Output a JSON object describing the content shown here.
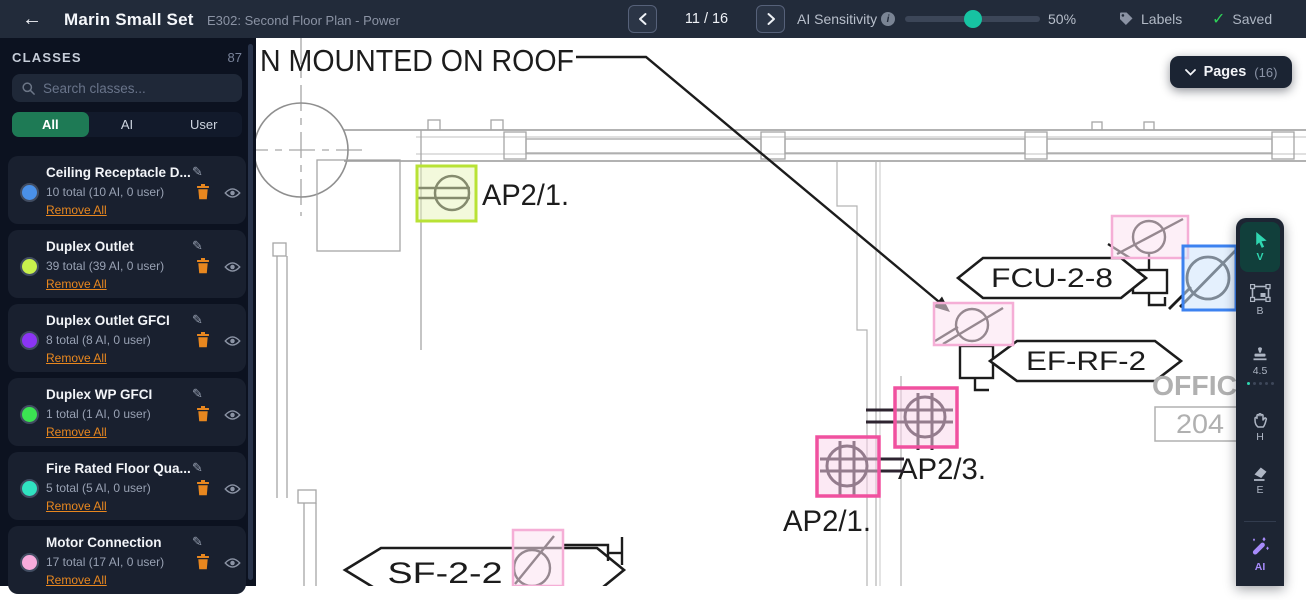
{
  "topbar": {
    "title": "Marin Small Set",
    "subtitle": "E302: Second Floor Plan - Power",
    "page_indicator": "11 / 16",
    "ai_sensitivity": {
      "label": "AI Sensitivity",
      "display": "50%"
    },
    "labels_button": "Labels",
    "saved_status": "Saved"
  },
  "sidebar": {
    "header": "CLASSES",
    "total_count": "87",
    "search": {
      "placeholder": "Search classes..."
    },
    "filter_tabs": {
      "options": [
        "All",
        "AI",
        "User"
      ],
      "active": "All"
    },
    "classes": [
      {
        "name": "Ceiling Receptacle D...",
        "color": "#4a90e8",
        "count_text": "10 total (10 AI, 0 user)",
        "remove_label": "Remove All"
      },
      {
        "name": "Duplex Outlet",
        "color": "#c8f04d",
        "count_text": "39 total (39 AI, 0 user)",
        "remove_label": "Remove All"
      },
      {
        "name": "Duplex Outlet GFCI",
        "color": "#8b35f4",
        "count_text": "8 total (8 AI, 0 user)",
        "remove_label": "Remove All"
      },
      {
        "name": "Duplex WP GFCI",
        "color": "#3be352",
        "count_text": "1 total (1 AI, 0 user)",
        "remove_label": "Remove All"
      },
      {
        "name": "Fire Rated Floor Qua...",
        "color": "#30e2c1",
        "count_text": "5 total (5 AI, 0 user)",
        "remove_label": "Remove All"
      },
      {
        "name": "Motor Connection",
        "color": "#f7abdc",
        "count_text": "17 total (17 AI, 0 user)",
        "remove_label": "Remove All"
      }
    ]
  },
  "canvas": {
    "pages_button": {
      "label": "Pages",
      "count": "(16)"
    },
    "drawing": {
      "roof_note": "N MOUNTED ON ROOF",
      "outlet_label_top": "AP2/1.",
      "fcu_tag": "FCU-2-8",
      "ef_tag": "EF-RF-2",
      "ap23_label": "AP2/3.",
      "ap21_label": "AP2/1.",
      "sf_tag": "SF-2-2",
      "room_name": "OFFICE",
      "room_number": "204"
    },
    "annotation_colors": {
      "duplex_outlet_green": "#b8e235",
      "motor_connection_pink": "#f5aed6",
      "receptacle_hot_pink": "#f0519f",
      "junction_blue": "#3c82f0"
    }
  },
  "toolbar": {
    "tools": [
      {
        "id": "select",
        "shortcut": "V"
      },
      {
        "id": "box",
        "shortcut": "B"
      },
      {
        "id": "stamp",
        "value": "4.5"
      },
      {
        "id": "hand",
        "shortcut": "H"
      },
      {
        "id": "eraser",
        "shortcut": "E"
      },
      {
        "id": "ai",
        "label": "AI"
      }
    ]
  },
  "colors": {
    "accent_teal": "#17c3a2",
    "active_green": "#1e7a55",
    "link_orange": "#e8871f",
    "saved_green": "#2ed158"
  }
}
